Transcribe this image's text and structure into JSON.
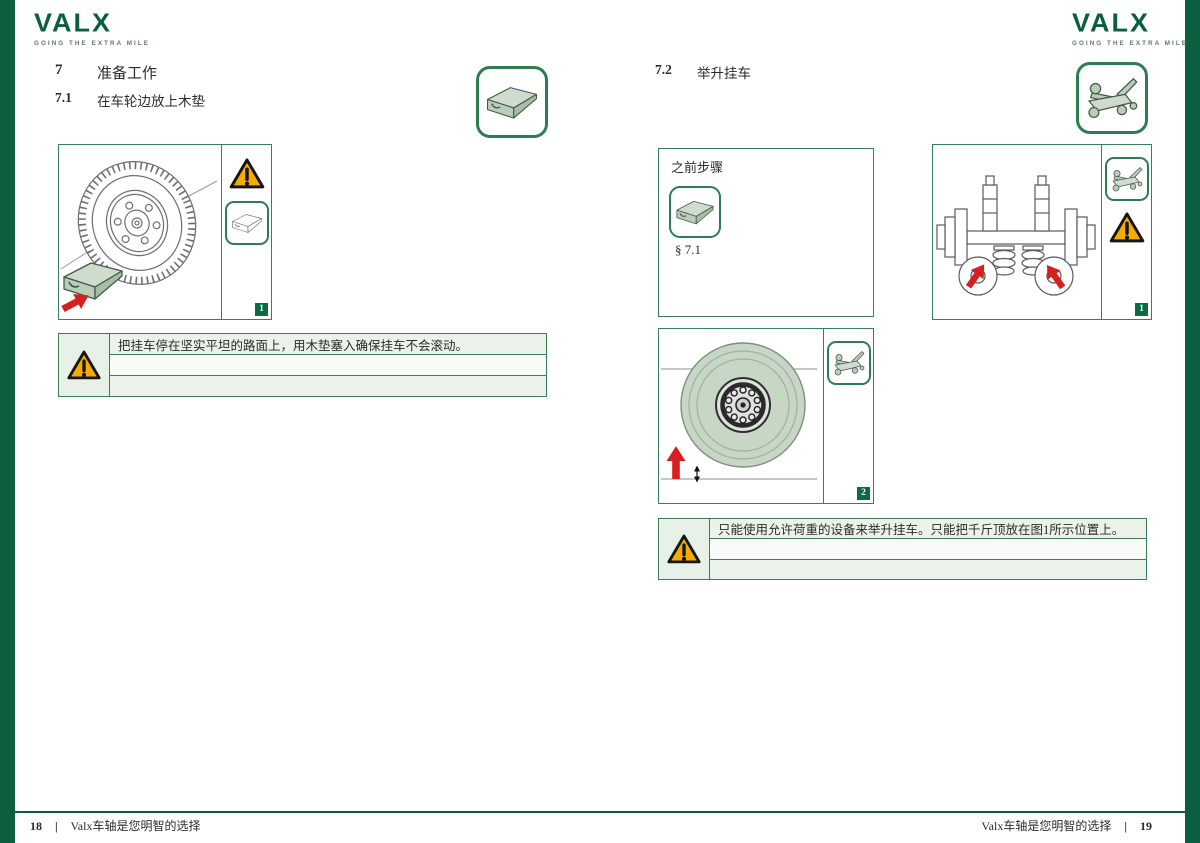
{
  "brand": {
    "logo_text": "VALX",
    "tagline": "GOING THE EXTRA MILE"
  },
  "colors": {
    "brand_green": "#0b5f3e",
    "border_green": "#3a7d5a",
    "warning_yellow": "#f5ac00",
    "arrow_red": "#d6201f",
    "sage": "#c7d6c5",
    "row_tint": "#eaf2e9"
  },
  "left_page": {
    "section_number": "7",
    "section_title": "准备工作",
    "sub_number": "7.1",
    "sub_title": "在车轮边放上木垫",
    "figure_badge": "1",
    "warning_text": "把挂车停在坚实平坦的路面上，用木垫塞入确保挂车不会滚动。",
    "footer": {
      "page_number": "18",
      "separator": "|",
      "slogan": "Valx车轴是您明智的选择"
    }
  },
  "right_page": {
    "sub_number": "7.2",
    "sub_title": "举升挂车",
    "prev_steps": {
      "title": "之前步骤",
      "reference": "§ 7.1"
    },
    "figure1_badge": "1",
    "figure2_badge": "2",
    "warning_text": "只能使用允许荷重的设备来举升挂车。只能把千斤顶放在图1所示位置上。",
    "footer": {
      "slogan": "Valx车轴是您明智的选择",
      "separator": "|",
      "page_number": "19"
    }
  }
}
